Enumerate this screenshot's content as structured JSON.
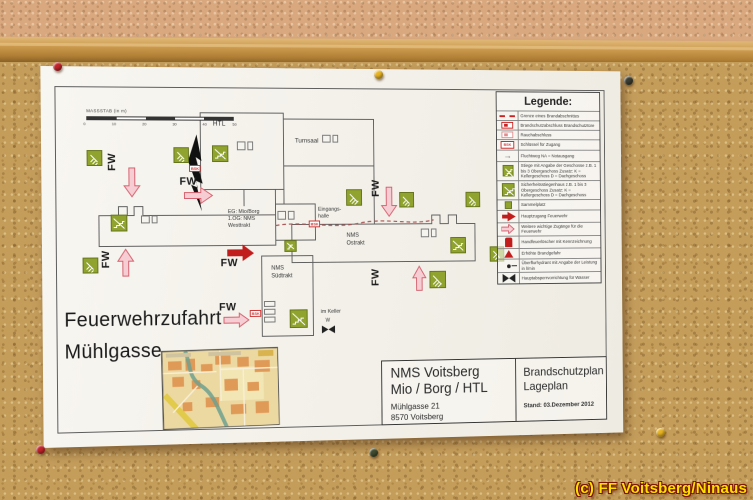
{
  "scene": {
    "credit": "(c) FF Voitsberg/Ninaus"
  },
  "plan": {
    "scale_label": "MASSSTAB (in m)",
    "scale_ticks": [
      "0",
      "10",
      "20",
      "30",
      "40",
      "50"
    ],
    "labels": {
      "htl": "HTL",
      "turnsaal": "Turnsaal",
      "west_line1": "EG: Mio/Borg",
      "west_line2": "1.OG: NMS",
      "west_line3": "Westtrakt",
      "eingang_line1": "Eingangs-",
      "eingang_line2": "halle",
      "ost_line1": "NMS",
      "ost_line2": "Ostrakt",
      "sued_line1": "NMS",
      "sued_line2": "Südtrakt",
      "keller": "im Keller",
      "keller_w": "W",
      "fw": "FW",
      "bsk": "BSK",
      "zufahrt_line1": "Feuerwehrzufahrt",
      "zufahrt_line2": "Mühlgasse"
    },
    "legend": {
      "title": "Legende:",
      "rows": [
        {
          "icon": "boundary-line-icon",
          "label": "Grenze eines Brandabschnittes"
        },
        {
          "icon": "fire-door-icon",
          "label": "Brandschutzabschluss Brandschutztüre"
        },
        {
          "icon": "smoke-door-icon",
          "label": "Rauchabschluss"
        },
        {
          "icon": "key-access-icon",
          "label": "Schlüssel für Zugang"
        },
        {
          "icon": "escape-route-icon",
          "label": "Fluchtweg NA = Notausgang"
        },
        {
          "icon": "stairs-icon",
          "label": "Stiege mit Angabe der Geschosse z.B. 1 bis 3 Obergeschoss Zusatz: K = Kellergeschoss D = Dachgeschoss"
        },
        {
          "icon": "safety-stairwell-icon",
          "label": "Sicherheitsstiegenhaus z.B. 1 bis 3 Obergeschoss Zusatz: K = Kellergeschoss D = Dachgeschoss"
        },
        {
          "icon": "assembly-point-icon",
          "label": "Sammelplatz"
        },
        {
          "icon": "main-access-icon",
          "label": "Hauptzugang Feuerwehr"
        },
        {
          "icon": "side-access-icon",
          "label": "Weitere wichtige Zugänge für die Feuerwehr"
        },
        {
          "icon": "extinguisher-icon",
          "label": "Handfeuerlöscher mit Kennzeichnung"
        },
        {
          "icon": "fire-danger-icon",
          "label": "Erhöhte Brandgefahr"
        },
        {
          "icon": "hydrant-icon",
          "label": "Überflurhydrant mit Angabe der Leistung in l/min"
        },
        {
          "icon": "water-shutoff-icon",
          "label": "Hauptabsperrvorrichtung für Wasser"
        }
      ]
    },
    "title_block": {
      "name_line1": "NMS Voitsberg",
      "name_line2": "Mio / Borg / HTL",
      "address_line1": "Mühlgasse 21",
      "address_line2": "8570 Voitsberg",
      "doc_line1": "Brandschutzplan",
      "doc_line2": "Lageplan",
      "date": "Stand: 03.Dezember 2012"
    },
    "colors": {
      "accent_red": "#c21d1d",
      "stair_green": "#8fa32e",
      "access_pink": "#f7cdd4"
    }
  }
}
